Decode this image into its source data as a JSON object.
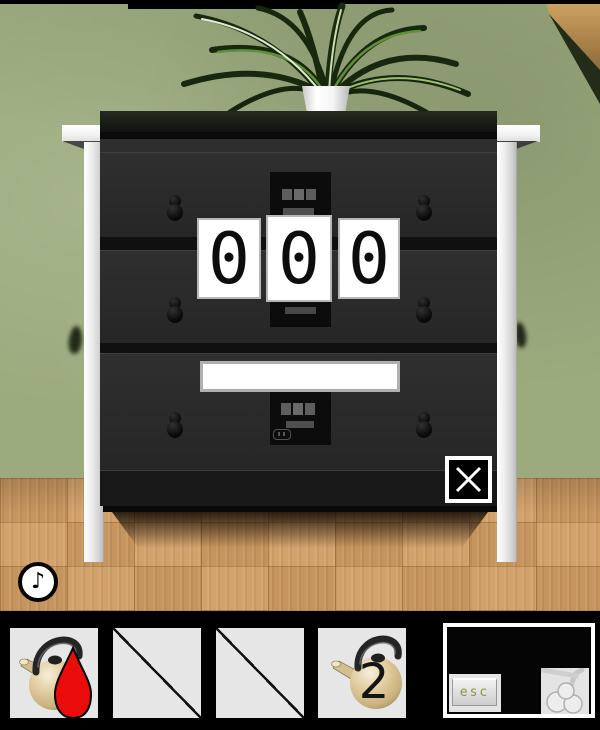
{
  "scene": {
    "name": "escape-room-dresser-view",
    "colors": {
      "wall_green": "#9cab7e",
      "floor_wood": "#cf9c63",
      "dresser_black": "#2a2a2a",
      "frame_white": "#f0f0f0",
      "card_white": "#ffffff",
      "liquid_red": "#ea0b0b",
      "kettle_tan": "#e0cb9d",
      "slot_gray": "#e6e6e6"
    }
  },
  "lock_panel": {
    "digits": [
      "0",
      "0",
      "0"
    ]
  },
  "close_button": {
    "icon": "x-cross"
  },
  "audio": {
    "music_note_glyph": "♪"
  },
  "inventory": {
    "slot1_item": "kettle-with-red-liquid",
    "slot2_item": "empty-diagonal-slash",
    "slot3_item": "empty-diagonal-slash",
    "slot4_item": "kettle",
    "kettle_badge": "2",
    "slot5_item": "esc-key-with-steam",
    "esc_label": "esc"
  }
}
